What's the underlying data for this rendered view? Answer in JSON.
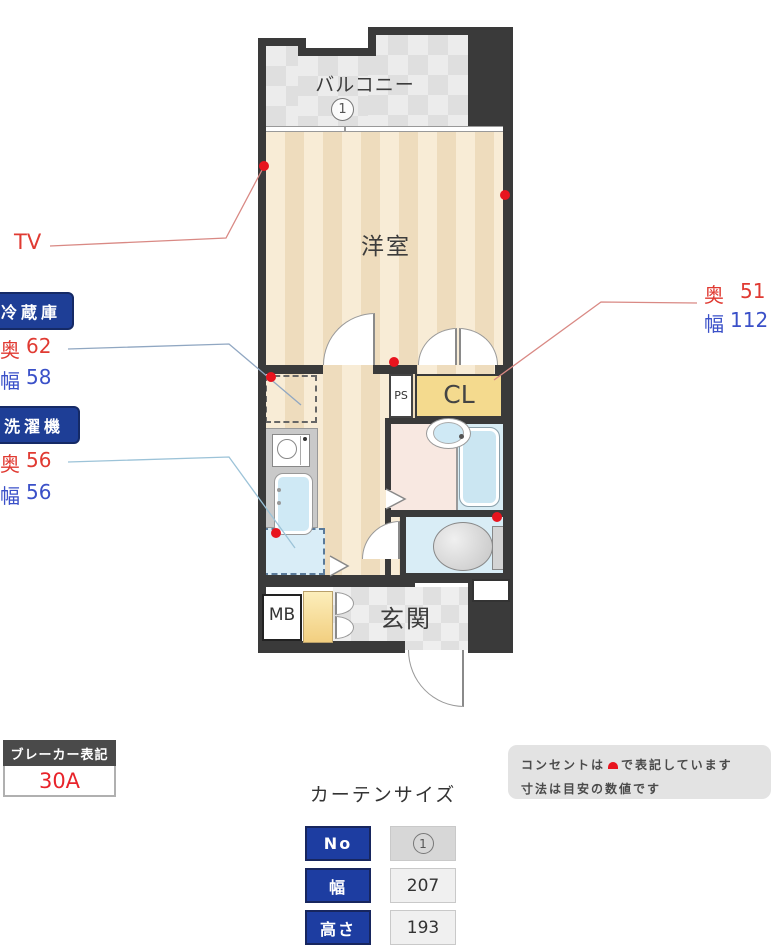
{
  "colors": {
    "wall_dark": "#3a3a3a",
    "accent_red": "#e8141e",
    "annotation_red": "#e03a32",
    "annotation_blue": "#3a50c8",
    "badge_navy": "#1e3e96",
    "closet_yellow": "#f4da8e",
    "note_gray": "#e3e3e3"
  },
  "plan": {
    "balcony_label": "バルコニー",
    "balcony_no": "1",
    "living_label": "洋室",
    "ps_label": "PS",
    "closet_label": "CL",
    "mb_label": "MB",
    "entrance_label": "玄関"
  },
  "annotations": {
    "tv_label": "TV",
    "fridge": {
      "title": "冷蔵庫",
      "rows": [
        {
          "label": "奥",
          "value": "62"
        },
        {
          "label": "幅",
          "value": "58"
        }
      ]
    },
    "washer": {
      "title": "洗濯機",
      "rows": [
        {
          "label": "奥",
          "value": "56"
        },
        {
          "label": "幅",
          "value": "56"
        }
      ]
    },
    "closet": {
      "rows": [
        {
          "label": "奥",
          "value": "51"
        },
        {
          "label": "幅",
          "value": "112"
        }
      ]
    }
  },
  "breaker": {
    "title": "ブレーカー表記",
    "value": "30A"
  },
  "curtain": {
    "title": "カーテンサイズ",
    "rows": [
      {
        "label": "No",
        "value": "1"
      },
      {
        "label": "幅",
        "value": "207"
      },
      {
        "label": "高さ",
        "value": "193"
      }
    ]
  },
  "note": {
    "line1_before": "コンセントは",
    "line1_after": "で表記しています",
    "line2": "寸法は目安の数値です"
  }
}
